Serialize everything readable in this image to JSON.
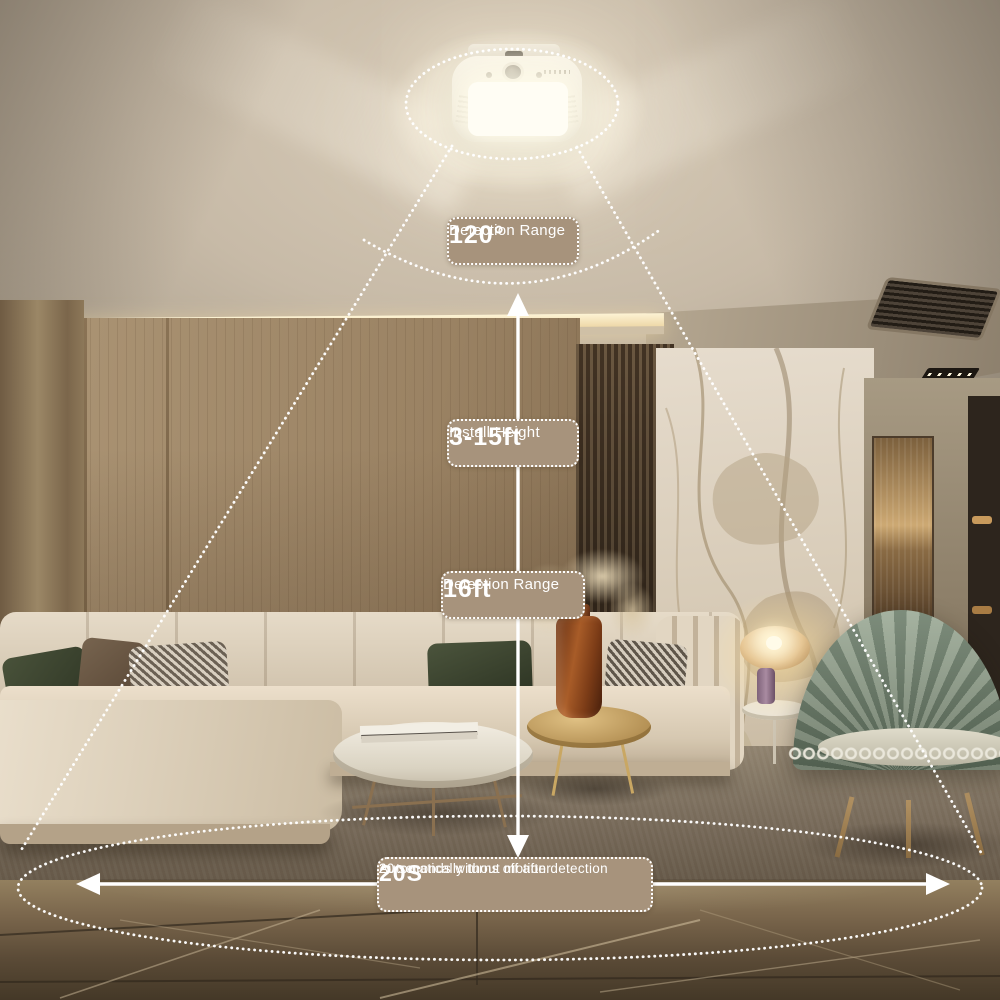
{
  "annotations": {
    "detection_angle": {
      "title": "Detection Range",
      "value": "120°"
    },
    "install_height": {
      "title": "Install Height",
      "value": "3-15ft"
    },
    "detection_distance": {
      "title": "Detection Range",
      "value": "16ft"
    },
    "auto_off": {
      "value": "20S",
      "line1": "Automatically turns off after",
      "line2": "20 seconds without motion detection"
    }
  },
  "colors": {
    "label_bg": "#a7937c",
    "label_text": "#ffffff",
    "annotation_line": "#ffffff"
  }
}
